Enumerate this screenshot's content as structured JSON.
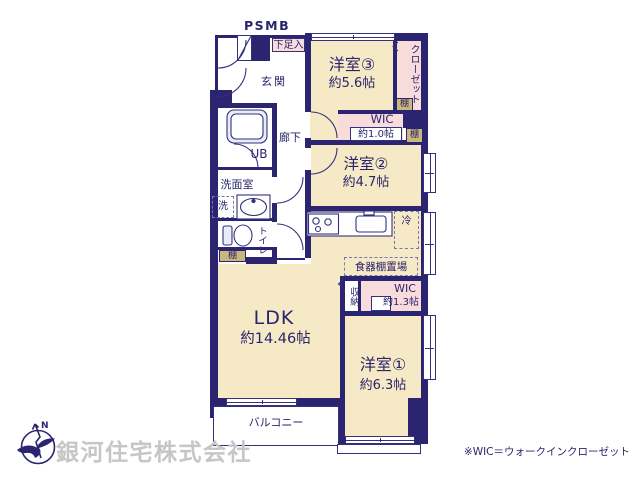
{
  "colors": {
    "wall": "#2b2470",
    "text_navy": "#29246e",
    "room_beige": "#f6e9c5",
    "closet_pink": "#f8dbdb",
    "shelf_tan": "#c9b77c",
    "fixture_blue": "#e8eef9",
    "company_gray": "#c6c6c6"
  },
  "labels": {
    "psmb": "PSMB",
    "shoe_box": "下足入",
    "entrance": "玄関",
    "hallway": "廊下",
    "unit_bath": "UB",
    "washroom": "洗面室",
    "washer": "洗",
    "toilet": "トイレ",
    "shelf": "棚",
    "fridge": "冷",
    "cupboard_space": "食器棚置場",
    "storage": "収納",
    "closet": "クローゼット",
    "balcony": "バルコニー",
    "north": "N"
  },
  "rooms": {
    "western3": {
      "name": "洋室③",
      "area": "約5.6帖"
    },
    "western2": {
      "name": "洋室②",
      "area": "約4.7帖"
    },
    "western1": {
      "name": "洋室①",
      "area": "約6.3帖"
    },
    "ldk": {
      "name": "LDK",
      "area": "約14.46帖"
    },
    "wic_upper": {
      "name": "WIC",
      "area": "約1.0帖"
    },
    "wic_lower": {
      "name": "WIC",
      "area": "約1.3帖"
    }
  },
  "footer": {
    "company": "銀河住宅株式会社",
    "wic_note": "※WIC＝ウォークインクローゼット"
  }
}
